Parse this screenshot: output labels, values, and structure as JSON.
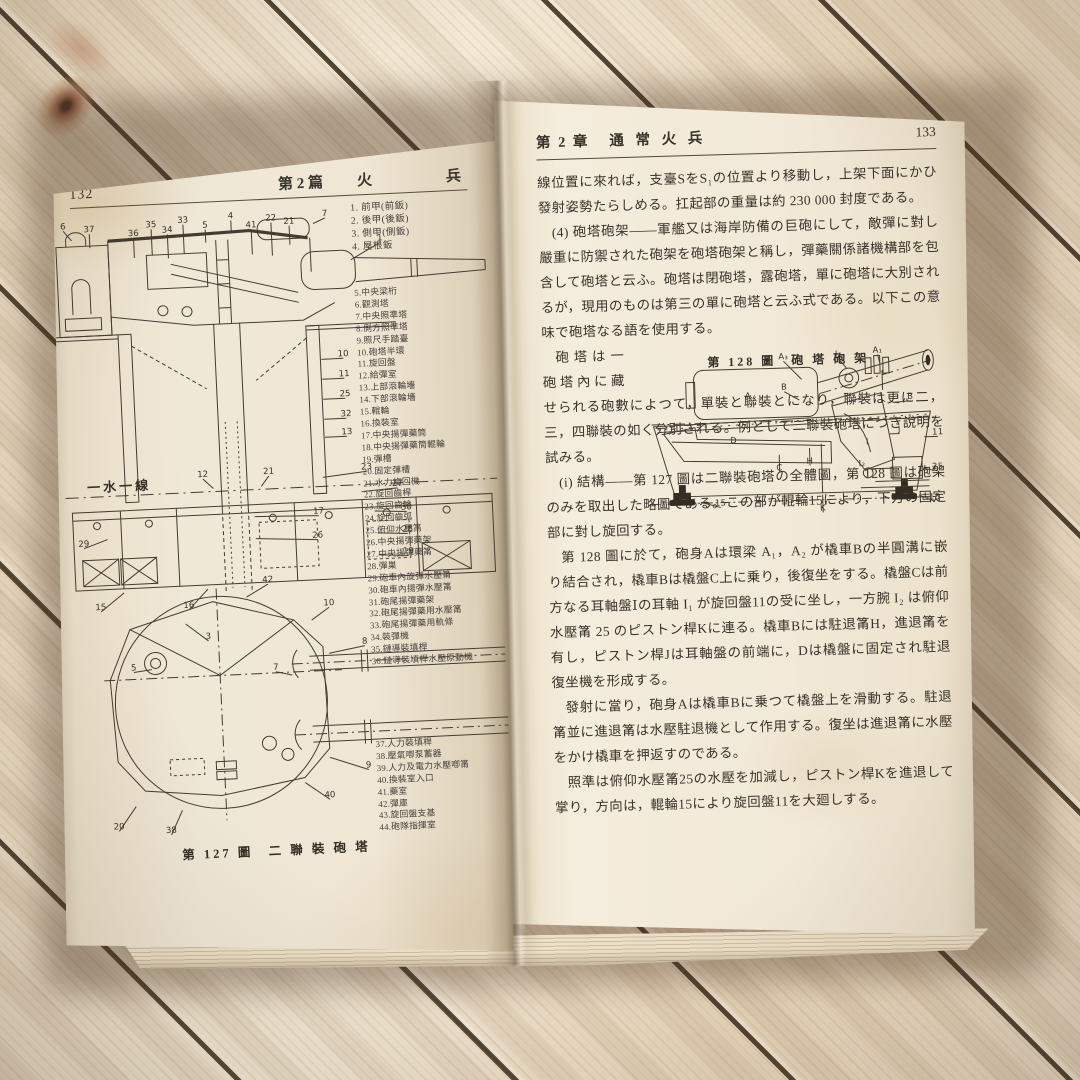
{
  "left": {
    "page_number": "132",
    "header": {
      "book": "第 2 篇",
      "t1": "火",
      "t2": "兵"
    },
    "parts_g1": [
      "1. 前甲(前鈑)",
      "2. 後甲(後鈑)",
      "3. 側甲(側鈑)",
      "4. 屋根鈑"
    ],
    "parts_g2": [
      "5.中央梁桁",
      "6.觀測塔",
      "7.中央照準塔",
      "8.側方照準塔",
      "9.照尺手踏臺",
      "10.砲塔半環",
      "11.旋回盤",
      "12.給彈室",
      "13.上部滾輪墻",
      "14.下部滾輪墻",
      "15.輥輪",
      "16.換裝室",
      "17.中央揚彈藥筒",
      "18.中央揚彈藥筒輥輪",
      "19.彈槽",
      "20.固定彈槽",
      "21.水力旋回機",
      "22.旋回齒桿",
      "23.旋回齒輪",
      "24.旋回齒弧",
      "25.俯仰水壓筩",
      "26.中央揚彈藥架",
      "27.中央揚彈藥筩",
      "28.彈巣",
      "29.砲車內旋彈水壓筩",
      "30.砲車內揚彈水壓筩",
      "31.砲尾揚彈藥架",
      "32.砲尾揚彈藥用水壓筩",
      "33.砲尾揚彈藥用軌條",
      "34.裝彈機",
      "35.鏈導裝填桿",
      "36.鏈導裝填桿水壓原動機"
    ],
    "parts_g3": [
      "37.人力裝填桿",
      "38.壓氣喞泵蓄器",
      "39.人力及電力水壓喞筩",
      "40.換裝室入口",
      "41.藥室",
      "42.彈庫",
      "43.旋回盤支基",
      "44.砲隊指揮室"
    ],
    "fig127": {
      "caption": "第 127 圖　二 聯 裝 砲 塔",
      "cs_labels": [
        {
          "t": "6",
          "x": 14,
          "y": 10,
          "lx": 22,
          "ly": 22
        },
        {
          "t": "37",
          "x": 40,
          "y": 14,
          "lx": 40,
          "ly": 30
        },
        {
          "t": "36",
          "x": 84,
          "y": 20,
          "lx": 84,
          "ly": 42
        },
        {
          "t": "35",
          "x": 102,
          "y": 12,
          "lx": 102,
          "ly": 40
        },
        {
          "t": "34",
          "x": 118,
          "y": 18,
          "lx": 118,
          "ly": 44
        },
        {
          "t": "33",
          "x": 134,
          "y": 9,
          "lx": 134,
          "ly": 40
        },
        {
          "t": "5",
          "x": 156,
          "y": 15,
          "lx": 156,
          "ly": 30
        },
        {
          "t": "4",
          "x": 182,
          "y": 7,
          "lx": 182,
          "ly": 22
        },
        {
          "t": "41",
          "x": 202,
          "y": 17,
          "lx": 202,
          "ly": 44
        },
        {
          "t": "22",
          "x": 222,
          "y": 11,
          "lx": 222,
          "ly": 46
        },
        {
          "t": "21",
          "x": 240,
          "y": 15,
          "lx": 240,
          "ly": 36
        },
        {
          "t": "7",
          "x": 276,
          "y": 9,
          "lx": 264,
          "ly": 16
        },
        {
          "t": "1",
          "x": 330,
          "y": 36,
          "lx": 300,
          "ly": 54
        },
        {
          "t": "10",
          "x": 288,
          "y": 150,
          "lx": 266,
          "ly": 152
        },
        {
          "t": "11",
          "x": 288,
          "y": 170,
          "lx": 266,
          "ly": 172
        },
        {
          "t": "25",
          "x": 288,
          "y": 190,
          "lx": 266,
          "ly": 192
        },
        {
          "t": "32",
          "x": 288,
          "y": 210,
          "lx": 266,
          "ly": 212
        },
        {
          "t": "13",
          "x": 288,
          "y": 228,
          "lx": 266,
          "ly": 230
        },
        {
          "t": "12",
          "x": 142,
          "y": 264,
          "lx": 152,
          "ly": 276
        },
        {
          "t": "21",
          "x": 208,
          "y": 264,
          "lx": 200,
          "ly": 276
        },
        {
          "t": "23",
          "x": 306,
          "y": 264,
          "lx": 262,
          "ly": 270
        },
        {
          "t": "27",
          "x": 336,
          "y": 282,
          "lx": 300,
          "ly": 286
        },
        {
          "t": "17",
          "x": 256,
          "y": 306,
          "lx": 192,
          "ly": 306
        },
        {
          "t": "30",
          "x": 344,
          "y": 306,
          "lx": 312,
          "ly": 306
        },
        {
          "t": "26",
          "x": 254,
          "y": 330,
          "lx": 192,
          "ly": 328
        },
        {
          "t": "28",
          "x": 344,
          "y": 328,
          "lx": 314,
          "ly": 328
        },
        {
          "t": "19",
          "x": 344,
          "y": 350,
          "lx": 314,
          "ly": 350
        },
        {
          "t": "29",
          "x": 20,
          "y": 328,
          "lx": 44,
          "ly": 322
        },
        {
          "t": "15",
          "x": 34,
          "y": 392,
          "lx": 58,
          "ly": 376
        },
        {
          "t": "16",
          "x": 122,
          "y": 394,
          "lx": 142,
          "ly": 376
        },
        {
          "t": "一水一線",
          "x": 58,
          "y": 274,
          "c": "wl"
        }
      ],
      "plan_labels": [
        {
          "t": "42",
          "x": 202,
          "y": 372,
          "lx": 180,
          "ly": 386
        },
        {
          "t": "10",
          "x": 262,
          "y": 398,
          "lx": 244,
          "ly": 412
        },
        {
          "t": "3",
          "x": 140,
          "y": 426,
          "lx": 118,
          "ly": 410
        },
        {
          "t": "8",
          "x": 296,
          "y": 438,
          "lx": 260,
          "ly": 446
        },
        {
          "t": "5",
          "x": 64,
          "y": 454,
          "lx": 82,
          "ly": 454
        },
        {
          "t": "7",
          "x": 206,
          "y": 460,
          "lx": 222,
          "ly": 466
        },
        {
          "t": "9",
          "x": 294,
          "y": 562,
          "lx": 256,
          "ly": 550
        },
        {
          "t": "40",
          "x": 254,
          "y": 590,
          "lx": 230,
          "ly": 574
        },
        {
          "t": "20",
          "x": 42,
          "y": 612,
          "lx": 60,
          "ly": 590
        },
        {
          "t": "38",
          "x": 94,
          "y": 618,
          "lx": 106,
          "ly": 596
        }
      ]
    }
  },
  "right": {
    "page_number": "133",
    "header": {
      "chap": "第 2 章",
      "title": "通 常 火 兵"
    },
    "paragraphs": [
      "線位置に來れば，支臺SをS₁の位置より移動し，上架下面にかひ發射姿勢たらしめる。扛起部の重量は約 230 000 封度である。",
      "(4) 砲塔砲架——軍艦又は海岸防備の巨砲にして，敵彈に對し嚴重に防禦された砲架を砲塔砲架と稱し，彈藥關係諸機構部を包含して砲塔と云ふ。砲塔は閉砲塔，露砲塔，單に砲塔に大別されるが，現用のものは第三の單に砲塔と云ふ式である。以下この意味で砲塔なる語を使用する。",
      "砲塔は一砲塔內に藏せられる砲數によつて，單裝と聯裝とになり，聯裝は更に二，三，四聯裝の如く分別される。例として二聯裝砲塔につき說明を試みる。",
      "(i) 結構——第 127 圖は二聯裝砲塔の全體圖，第 128 圖は砲架のみを取出した略圖である。この部が輥輪15により，下方の固定部に對し旋回する。",
      "第 128 圖に於て，砲身Aは環梁 A₁，A₂ が橇車Bの半圓溝に嵌り結合され，橇車Bは橇盤C上に乗り，後復坐をする。橇盤Cは前方なる耳軸盤Ⅰの耳軸 I₁ が旋回盤11の受に坐し，一方腕 I₂ は俯仰水壓筩 25 のピストン桿Kに連る。橇車Bには駐退筩H，進退筩を有し，ピストン桿Jは耳軸盤の前端に，Dは橇盤に固定され駐退復坐機を形成する。",
      "發射に當り，砲身Aは橇車Bに乗つて橇盤上を滑動する。駐退筩並に進退筩は水壓駐退機として作用する。復坐は進退筩に水壓をかけ橇車を押返すのである。",
      "照準は俯仰水壓筩25の水壓を加減し，ピストン桿Kを進退して掌り，方向は，輥輪15により旋回盤11を大廻しする。"
    ],
    "fig128": {
      "caption": "第 128 圖　砲 塔 砲 架",
      "labels": [
        {
          "t": "A₃",
          "x": 150,
          "y": 13,
          "lx": 168,
          "ly": 34
        },
        {
          "t": "I₁",
          "x": 206,
          "y": 12,
          "lx": 214,
          "ly": 24
        },
        {
          "t": "A₁",
          "x": 246,
          "y": 9,
          "lx": 248,
          "ly": 20
        },
        {
          "t": "A",
          "x": 113,
          "y": 52
        },
        {
          "t": "B",
          "x": 150,
          "y": 44,
          "lx": 165,
          "ly": 55
        },
        {
          "t": "B",
          "x": 278,
          "y": 57,
          "lx": 262,
          "ly": 60
        },
        {
          "t": "D",
          "x": 97,
          "y": 97
        },
        {
          "t": "C",
          "x": 143,
          "y": 126,
          "lx": 143,
          "ly": 110
        },
        {
          "t": "H",
          "x": 174,
          "y": 120,
          "lx": 174,
          "ly": 104
        },
        {
          "t": "I",
          "x": 233,
          "y": 102
        },
        {
          "t": "I₂",
          "x": 227,
          "y": 124
        },
        {
          "t": "J",
          "x": 266,
          "y": 90,
          "lx": 256,
          "ly": 92
        },
        {
          "t": "K",
          "x": 186,
          "y": 168,
          "lx": 186,
          "ly": 152
        },
        {
          "t": "11",
          "x": 305,
          "y": 94,
          "lx": 291,
          "ly": 96
        },
        {
          "t": "25",
          "x": 304,
          "y": 129,
          "lx": 289,
          "ly": 128
        },
        {
          "t": "15",
          "x": 82,
          "y": 160,
          "lx": 62,
          "ly": 156
        },
        {
          "t": "15",
          "x": 300,
          "y": 160,
          "lx": 284,
          "ly": 155
        }
      ]
    }
  }
}
